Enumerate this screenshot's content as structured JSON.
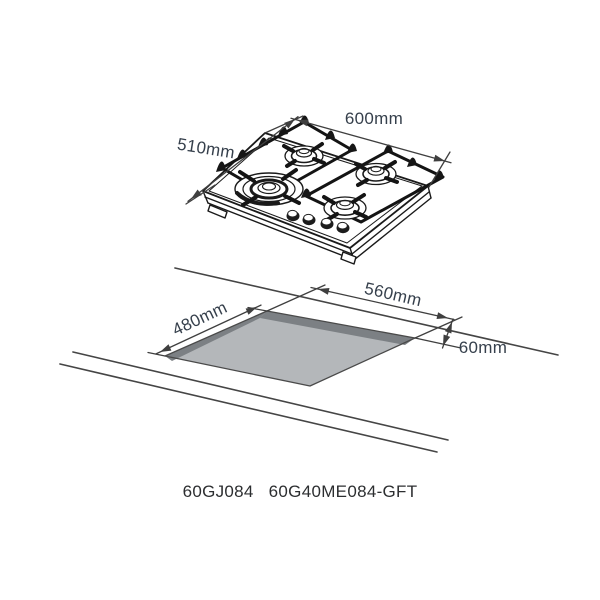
{
  "hob_figure": {
    "width_label": "600mm",
    "depth_label": "510mm",
    "burner_count": 4,
    "knob_count": 4
  },
  "cutout_figure": {
    "width_label": "560mm",
    "depth_label": "480mm",
    "clearance_label": "60mm",
    "floor_color": "#b4b7ba",
    "wall_color": "#7c8084"
  },
  "footer": {
    "model_left": "60GJ084",
    "model_right": "60G40ME084-GFT"
  },
  "colors": {
    "line_art": "#1a1a1a",
    "dimension_line": "#3f3f3f",
    "dimension_text": "#36404c",
    "model_text": "#2c2e30",
    "background": "#ffffff"
  }
}
